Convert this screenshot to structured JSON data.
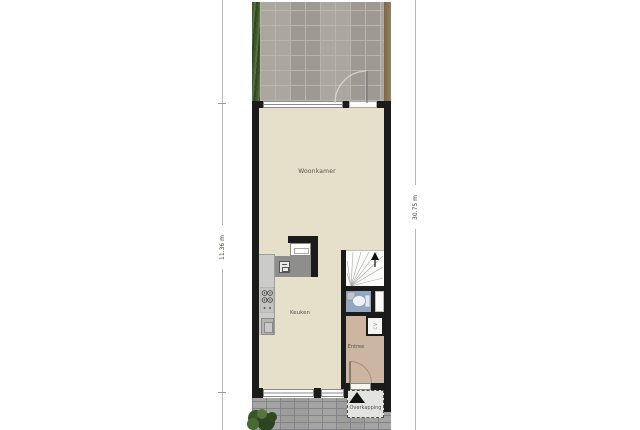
{
  "floorplan": {
    "labels": {
      "living_room": "Woonkamer",
      "kitchen": "Keuken",
      "entry": "Entree",
      "canopy": "Overkapping",
      "meter_closet": "CV"
    },
    "dimensions": {
      "left": "11.36 m",
      "right": "30.75 m"
    },
    "colors": {
      "wall": "#1b1b1b",
      "floor": "#e6dfca",
      "entry_floor": "#ccb5a1",
      "wc_floor": "#92a8c2",
      "tiles": "#a6a19b",
      "grout": "#b9b4ae",
      "hedge": "#4c6633",
      "fence": "#8b7456",
      "paving": "#9d9d9b",
      "canopy": "#e3e3e1",
      "arrow": "#111111"
    }
  }
}
